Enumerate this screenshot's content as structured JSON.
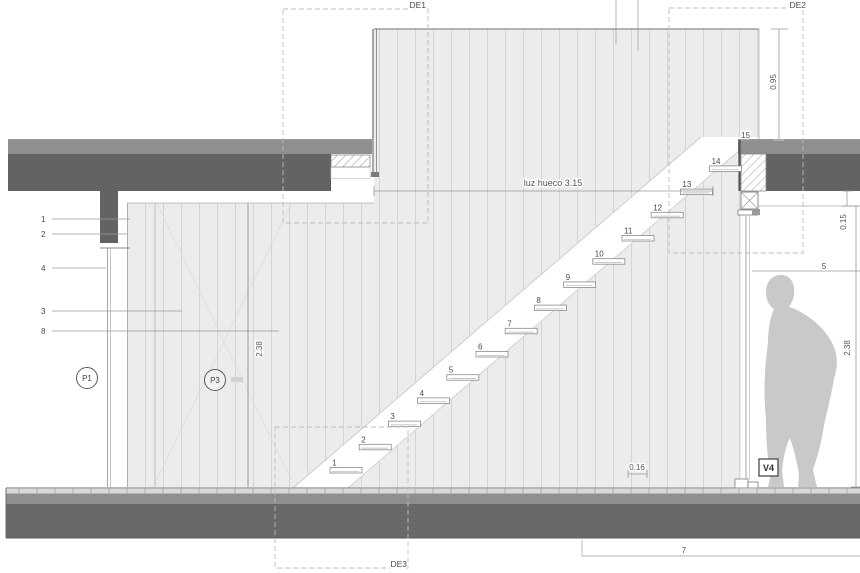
{
  "detail_callouts": {
    "de1": "DE1",
    "de2": "DE2",
    "de3": "DE3"
  },
  "dimensions": {
    "opening_width": "luz hueco 3.15",
    "parapet_height": "0.95",
    "ceiling_gap": "0.15",
    "clear_height_left": "2.38",
    "clear_height_right": "2.38",
    "plank_module": "0.16"
  },
  "material_callouts": {
    "n1": "1",
    "n2": "2",
    "n3": "3",
    "n4": "4",
    "n5": "5",
    "n7": "7",
    "n8": "8"
  },
  "wall_tags": {
    "p1": "P1",
    "p3": "P3"
  },
  "window_tag": "V4",
  "stairs": {
    "steps": [
      "1",
      "2",
      "3",
      "4",
      "5",
      "6",
      "7",
      "8",
      "9",
      "10",
      "11",
      "12",
      "13",
      "14",
      "15"
    ]
  },
  "colors": {
    "slab_dark": "#636363",
    "screed_gray": "#8f8f8f",
    "wall_bg": "#ececec",
    "wall_stripe": "#d4d4d4",
    "floor_dark": "#686868",
    "silhouette": "#c9c9c9",
    "callout_dash": "#bdbdbd",
    "text": "#4a4a4a"
  }
}
